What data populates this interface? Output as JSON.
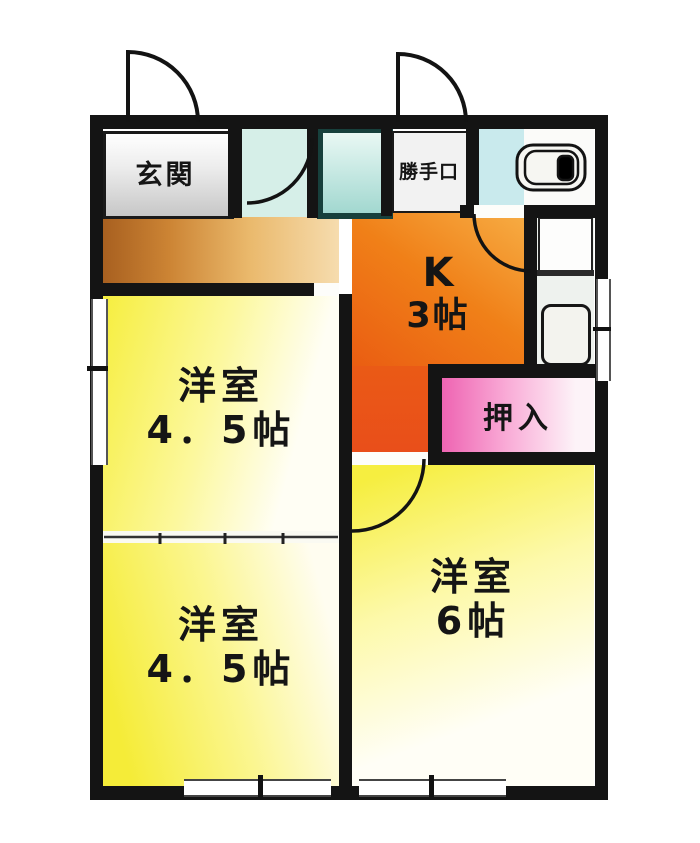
{
  "plan": {
    "type": "floor-plan",
    "rooms": {
      "genkan": {
        "label": "玄関"
      },
      "kitchen": {
        "label": "K",
        "size": "3帖"
      },
      "room_nw": {
        "label": "洋室",
        "size": "4．5帖"
      },
      "room_sw": {
        "label": "洋室",
        "size": "4．5帖"
      },
      "room_se": {
        "label": "洋室",
        "size": "6帖"
      },
      "oshiire": {
        "label": "押入"
      },
      "katteguchi": {
        "label": "勝手口"
      }
    },
    "fixtures": [
      "bathtub-icon",
      "toilet-icon",
      "washing-machine-pan-icon"
    ],
    "symbols": [
      "door-swing-arc",
      "window-symbol",
      "sliding-partition"
    ],
    "colors": {
      "wall": "#141414",
      "kitchen_orange": "#f08018",
      "kitchen_red": "#e94e1a",
      "room_yellow": "#f5ec38",
      "closet_pink": "#ee64b2",
      "wet_area_teal": "#cde9e4",
      "hallway_brown": "#c07a30",
      "genkan_gray": "#c7c7c7"
    }
  }
}
